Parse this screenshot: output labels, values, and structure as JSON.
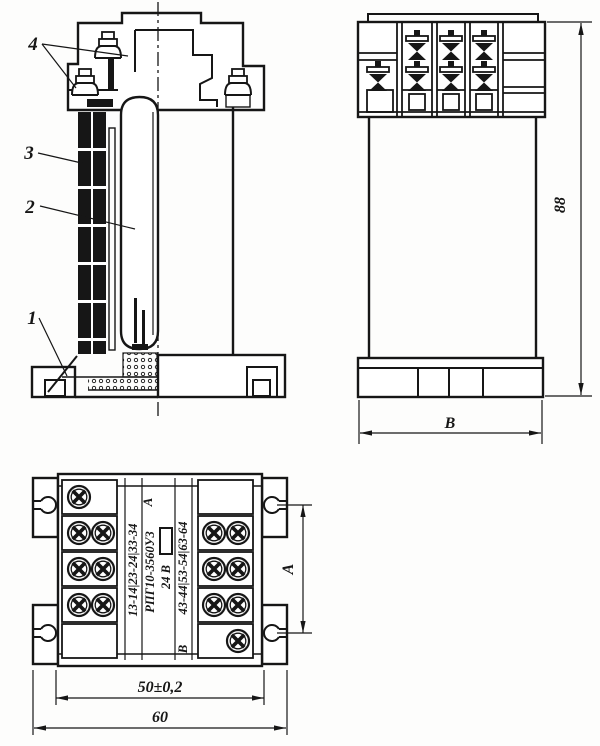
{
  "views": {
    "section": {
      "callouts": [
        {
          "label": "4",
          "target": "terminal-screws"
        },
        {
          "label": "3",
          "target": "contact-stack"
        },
        {
          "label": "2",
          "target": "sealed-capsule"
        },
        {
          "label": "1",
          "target": "base"
        }
      ]
    },
    "front": {
      "dim_height": "88",
      "dim_width_letter": "В"
    },
    "bottom": {
      "marking": {
        "group_a": "13-14|23-24|33-34",
        "letter_a": "А",
        "type": "РПГ10-3560У3",
        "voltage": "24 В",
        "letter_b": "В",
        "group_b": "43-44|53-54|63-64"
      },
      "dim_mount_width": "50±0,2",
      "dim_overall_width": "60",
      "dim_mount_height_letter": "А"
    }
  },
  "colors": {
    "line": "#161616",
    "background": "#fdfdfc"
  }
}
